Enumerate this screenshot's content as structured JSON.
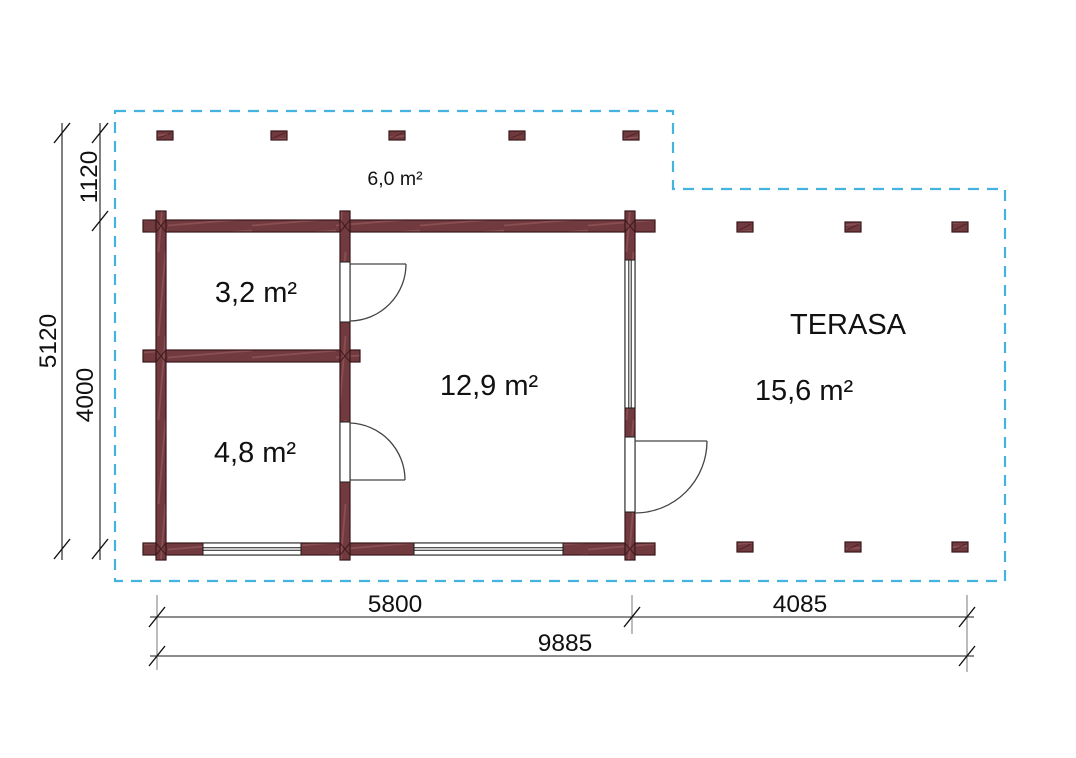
{
  "drawing": {
    "type": "floor-plan",
    "rooms": [
      {
        "id": "room-a",
        "area": "3,2 m²"
      },
      {
        "id": "room-b",
        "area": "4,8 m²"
      },
      {
        "id": "room-c",
        "area": "12,9 m²"
      }
    ],
    "porch": {
      "area": "6,0 m²"
    },
    "terrace": {
      "name": "TERASA",
      "area": "15,6 m²"
    },
    "dimensions": {
      "bottom_segment_1": "5800",
      "bottom_segment_2": "4085",
      "bottom_total": "9885",
      "left_overhang": "1120",
      "left_main": "4000",
      "left_total": "5120"
    },
    "colors": {
      "outline_dash": "#45b3e0",
      "wall_fill": "#713a3e",
      "wall_streak": "#8a4f53",
      "wall_stroke": "#381719",
      "dim_line": "#1a1a1a",
      "extension_line": "#7a7a7a",
      "text": "#111111",
      "background": "#ffffff"
    }
  }
}
